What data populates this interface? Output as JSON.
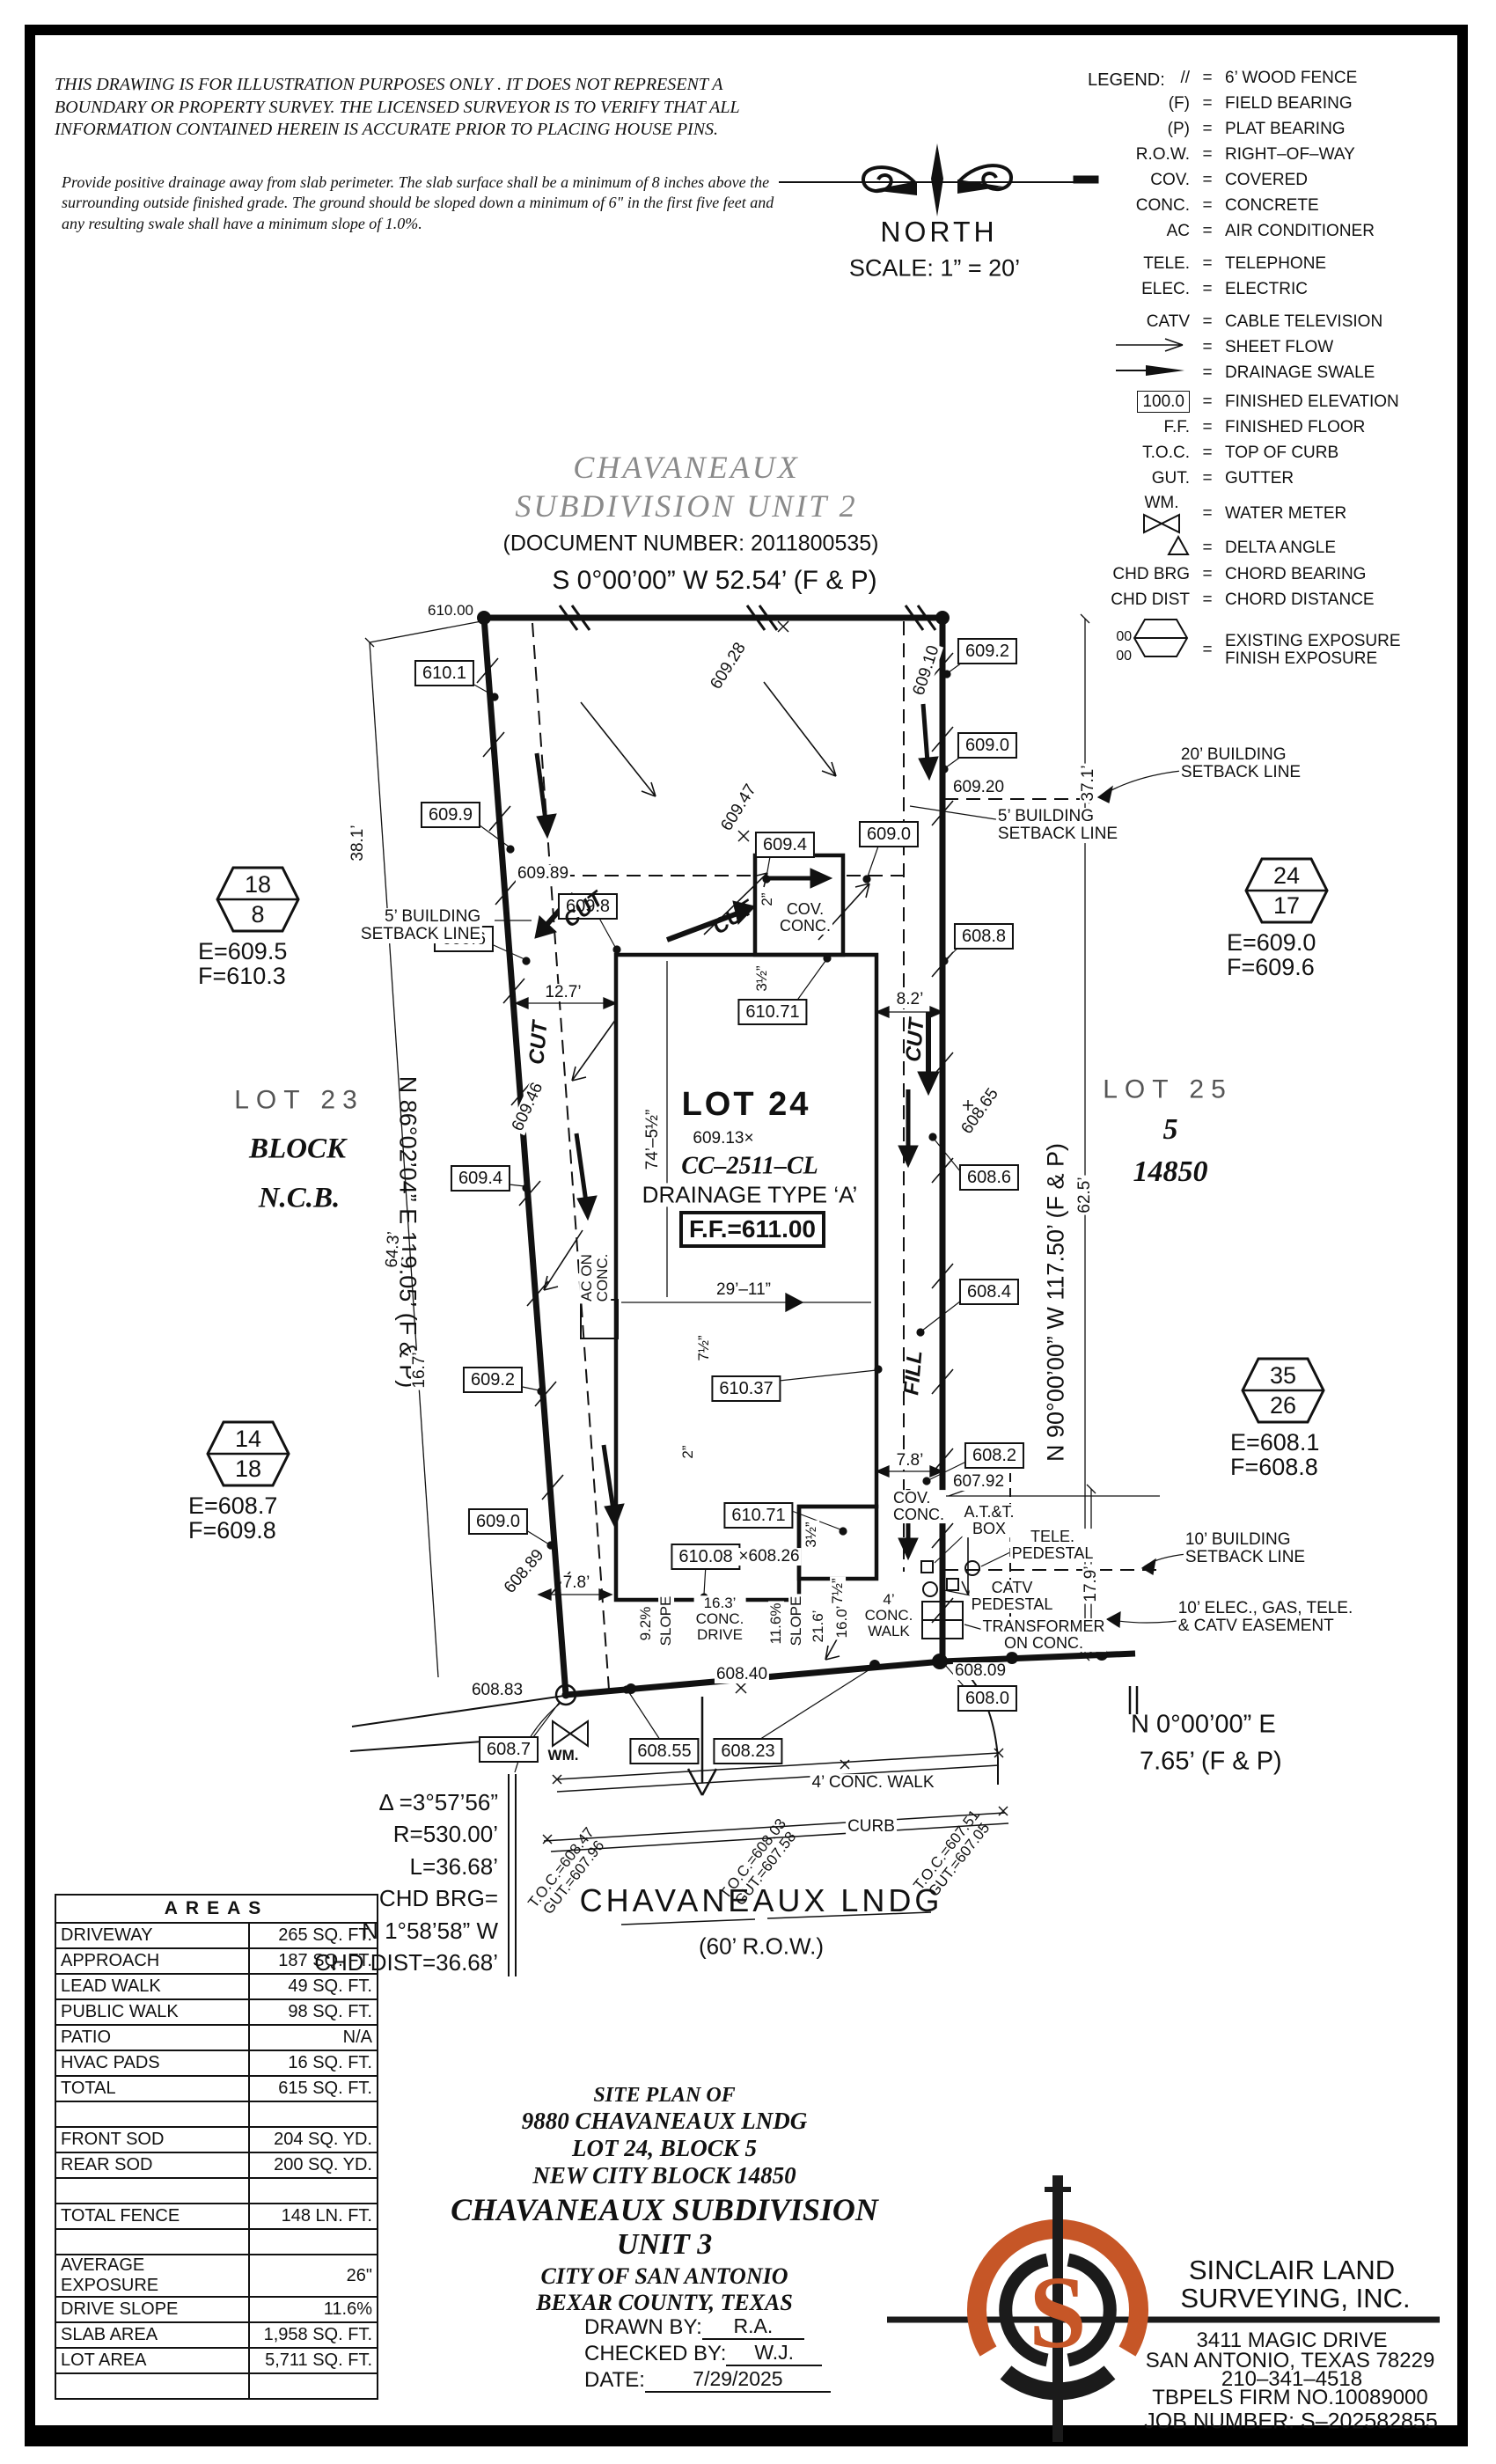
{
  "disclaimer": {
    "para1": "THIS DRAWING IS FOR ILLUSTRATION PURPOSES ONLY . IT DOES NOT REPRESENT A BOUNDARY OR PROPERTY SURVEY. THE LICENSED SURVEYOR IS TO VERIFY THAT ALL INFORMATION CONTAINED HEREIN IS ACCURATE PRIOR TO PLACING HOUSE PINS.",
    "para2": "Provide positive drainage away from slab perimeter. The slab surface shall be a minimum of 8 inches above the surrounding outside finished grade. The ground should be sloped down a minimum of 6\" in the first five feet and any resulting swale shall have a minimum slope of 1.0%."
  },
  "compass": {
    "north": "NORTH",
    "scale": "SCALE:  1”  =  20’"
  },
  "legend": {
    "title": "LEGEND:",
    "hex_top": "00",
    "hex_bottom": "00",
    "items": [
      {
        "sym": "//",
        "desc": "6’ WOOD FENCE"
      },
      {
        "sym": "(F)",
        "desc": "FIELD BEARING"
      },
      {
        "sym": "(P)",
        "desc": "PLAT BEARING"
      },
      {
        "sym": "R.O.W.",
        "desc": "RIGHT–OF–WAY"
      },
      {
        "sym": "COV.",
        "desc": "COVERED"
      },
      {
        "sym": "CONC.",
        "desc": "CONCRETE"
      },
      {
        "sym": "AC",
        "desc": "AIR CONDITIONER"
      },
      {
        "sym": "TELE.",
        "desc": "TELEPHONE"
      },
      {
        "sym": "ELEC.",
        "desc": "ELECTRIC"
      },
      {
        "sym": "CATV",
        "desc": "CABLE TELEVISION"
      },
      {
        "sym": "",
        "desc": "SHEET FLOW"
      },
      {
        "sym": "",
        "desc": "DRAINAGE SWALE"
      },
      {
        "sym": "100.0",
        "desc": "FINISHED ELEVATION"
      },
      {
        "sym": "F.F.",
        "desc": "FINISHED FLOOR"
      },
      {
        "sym": "T.O.C.",
        "desc": "TOP OF CURB"
      },
      {
        "sym": "GUT.",
        "desc": "GUTTER"
      },
      {
        "sym": "WM.",
        "desc": "WATER METER"
      },
      {
        "sym": "",
        "desc": "DELTA ANGLE"
      },
      {
        "sym": "CHD BRG",
        "desc": "CHORD BEARING"
      },
      {
        "sym": "CHD DIST",
        "desc": "CHORD DISTANCE"
      },
      {
        "sym": "",
        "desc": "EXISTING EXPOSURE\nFINISH EXPOSURE"
      }
    ]
  },
  "subdivision": {
    "name1": "CHAVANEAUX",
    "name2": "SUBDIVISION  UNIT  2",
    "doc": "(DOCUMENT  NUMBER:  2011800535)"
  },
  "bearings": {
    "top": "S  0°00’00”  W  52.54’  (F  &  P)",
    "left": "N  86°02’04”  E  119.05’  (F  &  P)",
    "right": "N  90°00’00”  W  117.50’  (F  &  P)",
    "bottom1": "N  0°00’00”  E",
    "bottom2": "7.65’  (F  &  P)"
  },
  "lot23": {
    "name": "LOT  23",
    "block": "BLOCK",
    "ncb": "N.C.B."
  },
  "lot25": {
    "name": "LOT  25",
    "block": "5",
    "ncb": "14850"
  },
  "lot24": {
    "name": "LOT 24",
    "spot": "609.13×",
    "cc": "CC–2511–CL",
    "drainage": "DRAINAGE  TYPE  ‘A’",
    "ff": "F.F.=611.00"
  },
  "hex": [
    {
      "top": "18",
      "bot": "8",
      "e": "E=609.5",
      "f": "F=610.3"
    },
    {
      "top": "24",
      "bot": "17",
      "e": "E=609.0",
      "f": "F=609.6"
    },
    {
      "top": "14",
      "bot": "18",
      "e": "E=608.7",
      "f": "F=609.8"
    },
    {
      "top": "35",
      "bot": "26",
      "e": "E=608.1",
      "f": "F=608.8"
    }
  ],
  "plan": {
    "el610_00": "610.00",
    "bx610_1": "610.1",
    "bx609_9": "609.9",
    "bx609_8": "609.8",
    "bx609_6": "609.6",
    "bx609_4L": "609.4",
    "bx609_2L": "609.2",
    "bx609_0L": "609.0",
    "el609_89": "609.89",
    "bx609_4T": "609.4",
    "bx609_0T": "609.0",
    "rot609_28": "609.28",
    "rot609_47": "609.47",
    "rot609_10": "609.10",
    "rot609_46": "609.46",
    "rot608_89": "608.89",
    "rot608_65": "608.65",
    "bx609_2R": "609.2",
    "bx609_0R": "609.0",
    "el609_20": "609.20",
    "bx608_8": "608.8",
    "bx608_6": "608.6",
    "bx608_4": "608.4",
    "bx608_2": "608.2",
    "el607_92": "607.92",
    "bx610_71a": "610.71",
    "bx610_37": "610.37",
    "bx610_71b": "610.71",
    "bx610_08": "610.08",
    "el608_26": "×608.26",
    "el608_83": "608.83",
    "bx608_7": "608.7",
    "bx608_55": "608.55",
    "bx608_23": "608.23",
    "el608_40": "608.40",
    "el608_09": "608.09",
    "bx608_0": "608.0",
    "wm": "WM.",
    "cut": "CUT",
    "fill": "FILL",
    "sb5": "5’ BUILDING\nSETBACK LINE",
    "sb20": "20’ BUILDING\nSETBACK LINE",
    "sb10": "10’ BUILDING\nSETBACK LINE",
    "esmt": "10’ ELEC., GAS, TELE.\n& CATV EASEMENT",
    "ac": "AC ON\nCONC.",
    "cov": "COV.\nCONC.",
    "att": "A.T.&T.\nBOX",
    "tele": "TELE.\nPEDESTAL",
    "catv": "CATV\nPEDESTAL",
    "xfmr": "TRANSFORMER\nON CONC.",
    "d38": "38.1’",
    "d37": "37.1’",
    "d64": "64.3’",
    "d62": "62.5’",
    "d167": "16.7’",
    "d179": "17.9’",
    "d127": "12.7’",
    "d82": "8.2’",
    "d78": "7.8’",
    "d74": "74’–5½”",
    "d29": "29’–11”",
    "d2": "2”",
    "d35": "3½”",
    "d75": "7½”",
    "slope92": "9.2%",
    "slope116": "11.6%",
    "slope_word": "SLOPE",
    "drive163": "16.3’\nCONC.\nDRIVE",
    "d216": "21.6’",
    "d160": "16.0’",
    "walk4": "4’\nCONC.\nWALK",
    "walk4s": "4’ CONC. WALK",
    "curb": "CURB",
    "toc1": "T.O.C.=608.47\nGUT.=607.96",
    "toc2": "T.O.C.=608.03\nGUT.=607.58",
    "toc3": "T.O.C.=607.51\nGUT.=607.05"
  },
  "curve": {
    "delta": "Δ =3°57’56”",
    "r": "R=530.00’",
    "l": "L=36.68’",
    "chd1": "CHD  BRG=",
    "chd2": "N  1°58’58”  W",
    "chd3": "CHD  DIST=36.68’"
  },
  "street": {
    "name": "CHAVANEAUX  LNDG",
    "row": "(60’  R.O.W.)"
  },
  "areas": {
    "title": "AREAS",
    "rows": [
      {
        "label": "DRIVEWAY",
        "value": "265 SQ. FT."
      },
      {
        "label": "APPROACH",
        "value": "187 SQ. FT."
      },
      {
        "label": "LEAD WALK",
        "value": "49 SQ. FT."
      },
      {
        "label": "PUBLIC WALK",
        "value": "98 SQ. FT."
      },
      {
        "label": "PATIO",
        "value": "N/A"
      },
      {
        "label": "HVAC PADS",
        "value": "16 SQ. FT."
      },
      {
        "label": "TOTAL",
        "value": "615 SQ. FT."
      },
      {
        "label": "",
        "value": ""
      },
      {
        "label": "FRONT SOD",
        "value": "204 SQ. YD."
      },
      {
        "label": "REAR SOD",
        "value": "200 SQ. YD."
      },
      {
        "label": "",
        "value": ""
      },
      {
        "label": "TOTAL FENCE",
        "value": "148  LN. FT."
      },
      {
        "label": "",
        "value": ""
      },
      {
        "label": "AVERAGE EXPOSURE",
        "value": "26\""
      },
      {
        "label": "DRIVE SLOPE",
        "value": "11.6%"
      },
      {
        "label": "SLAB AREA",
        "value": "1,958 SQ. FT."
      },
      {
        "label": "LOT AREA",
        "value": "5,711 SQ. FT."
      },
      {
        "label": "",
        "value": ""
      }
    ]
  },
  "titleblock": {
    "site": "SITE  PLAN  OF",
    "addr": "9880  CHAVANEAUX  LNDG",
    "lot": "LOT  24,  BLOCK  5",
    "ncb": "NEW  CITY  BLOCK  14850",
    "sub1": "CHAVANEAUX  SUBDIVISION",
    "sub2": "UNIT  3",
    "city": "CITY  OF  SAN  ANTONIO",
    "county": "BEXAR  COUNTY,  TEXAS",
    "drawn_label": "DRAWN  BY:",
    "drawn": "R.A.",
    "checked_label": "CHECKED  BY:",
    "checked": "W.J.",
    "date_label": "DATE:",
    "date": "7/29/2025"
  },
  "company": {
    "name1": "SINCLAIR  LAND",
    "name2": "SURVEYING,  INC.",
    "addr1": "3411  MAGIC  DRIVE",
    "addr2": "SAN  ANTONIO,  TEXAS  78229",
    "phone": "210–341–4518",
    "firm": "TBPELS  FIRM  NO.10089000",
    "job": "JOB  NUMBER:  S–202582855",
    "logo_letter": "S"
  },
  "colors": {
    "accent": "#c65627",
    "ink": "#111111",
    "title_gray": "#8a8a8a"
  }
}
